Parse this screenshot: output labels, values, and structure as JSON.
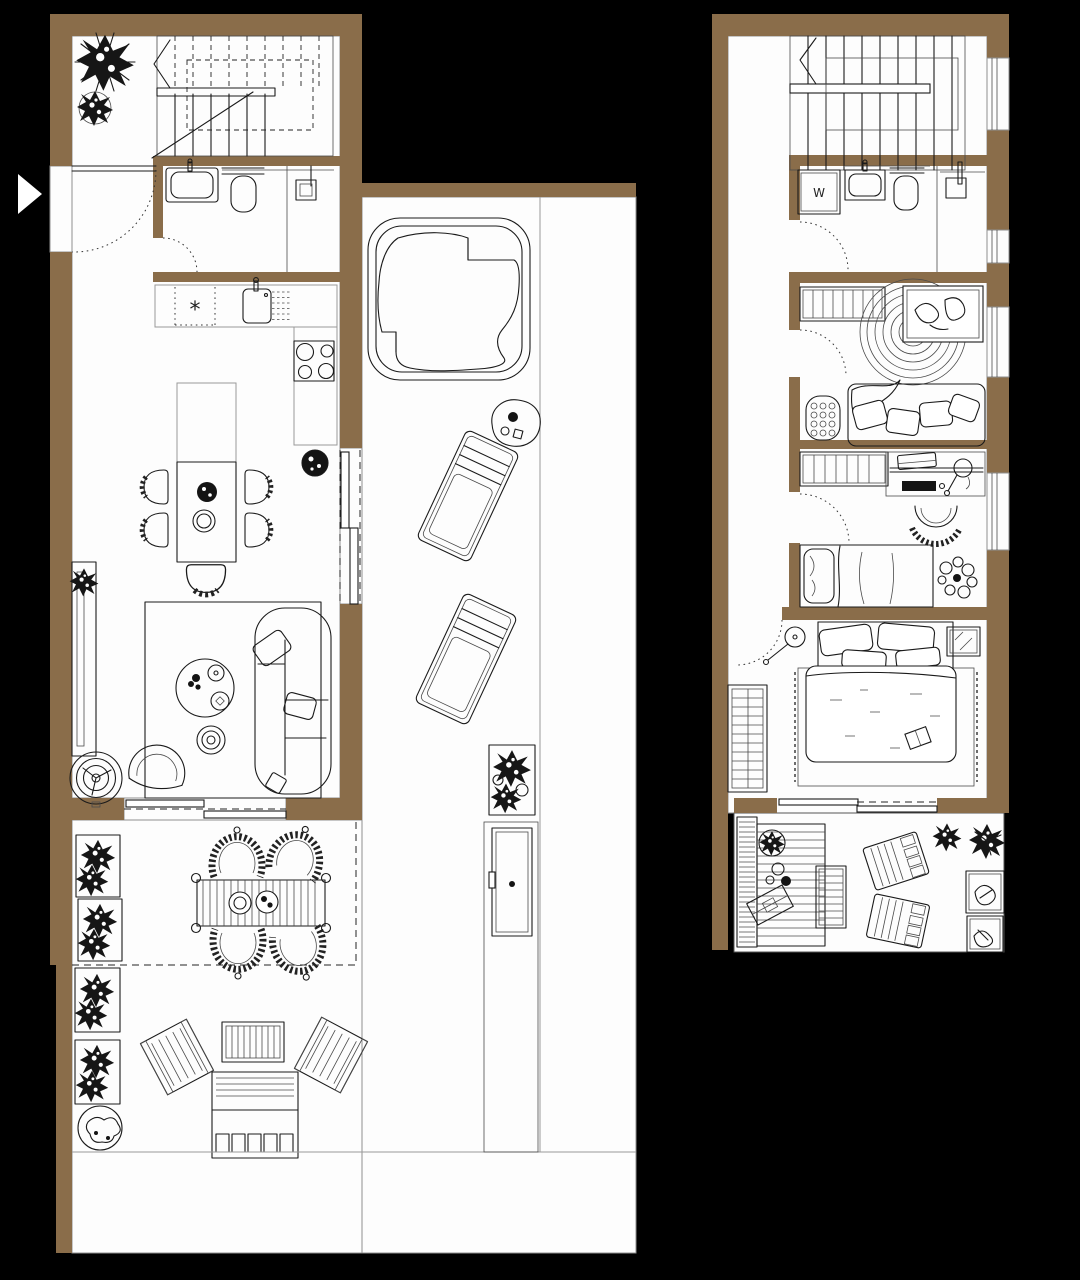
{
  "document": {
    "type": "architectural-floor-plan",
    "floors_shown": 2
  },
  "colors": {
    "background": "#000000",
    "wall": "#8a6d4a",
    "floor": "#fdfdfd",
    "line": "#1a1a1a",
    "thin": "#4a4a4a",
    "outline": "#8f8f8f"
  },
  "labels": {
    "washer": "W",
    "kitchen_symbol": "*"
  },
  "plans": [
    {
      "name": "ground-floor",
      "areas": [
        "entrance-hall",
        "staircase",
        "bathroom",
        "kitchen",
        "dining-area",
        "living-room",
        "covered-terrace",
        "open-terrace",
        "pool-terrace"
      ],
      "furniture": [
        "hall-plants",
        "staircase",
        "bath-sink",
        "toilet",
        "shower",
        "kitchen-counter",
        "kitchen-sink",
        "dish-rack",
        "cooktop",
        "potted-plant",
        "kitchen-island",
        "dining-table",
        "dining-chairs",
        "area-rug",
        "sofa",
        "coffee-table",
        "pouf",
        "armchair",
        "floor-fan",
        "sideboard",
        "sliding-doors",
        "planter-boxes",
        "outdoor-dining-table",
        "woven-chairs",
        "lounge-chairs",
        "slatted-table",
        "outdoor-sofa",
        "round-planter",
        "hot-tub",
        "side-table",
        "sun-loungers",
        "monstera-planter",
        "outdoor-shower"
      ]
    },
    {
      "name": "upper-floor",
      "areas": [
        "staircase",
        "hallway",
        "bathroom",
        "bedroom-1",
        "bedroom-2",
        "master-bedroom",
        "roof-terrace"
      ],
      "furniture": [
        "washing-machine",
        "bath-sink",
        "toilet",
        "shower",
        "wardrobe",
        "round-jute-rug",
        "wall-art",
        "daybed",
        "knitted-pouf",
        "desk",
        "desk-lamp",
        "laptop",
        "office-chair",
        "single-bed",
        "plant",
        "floor-lamp",
        "double-bed",
        "mirror",
        "fringed-rug",
        "shelf-unit",
        "wood-deck",
        "deck-plants",
        "serving-tray",
        "slatted-table",
        "deck-loungers",
        "planter-boxes"
      ]
    }
  ]
}
